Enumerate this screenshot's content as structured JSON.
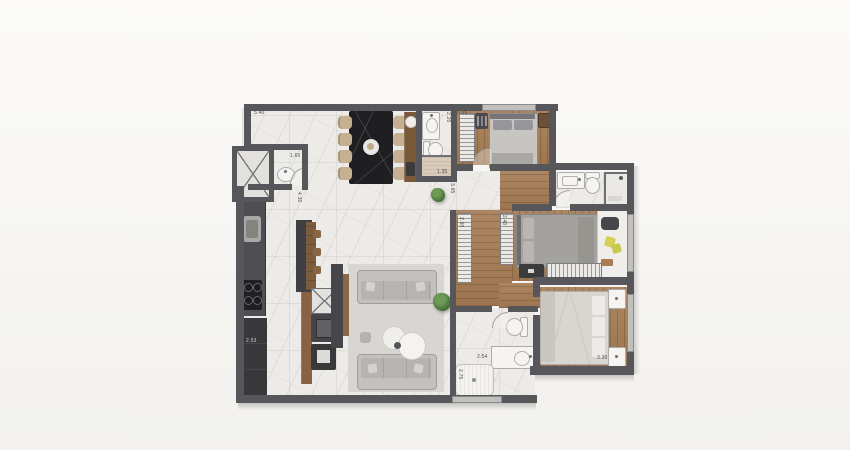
{
  "scene": {
    "type": "apartment-floor-plan-render",
    "style": "top-down 3D architectural render on white background"
  },
  "palette": {
    "wall": "#57565a",
    "marble_floor": "#edebe7",
    "wood_floor": "#a57c55",
    "kitchen_counter": "#4e4f53",
    "dining_table": "#1f1f22",
    "dining_chair": "#c6b092",
    "sofa": "#c3c1bd",
    "bed_gray": "#a3a29f",
    "bed_white": "#d9d6d1",
    "plant_green": "#4d7a3e",
    "pillow_yellow": "#d3d055",
    "label_text": "#4e4d49"
  },
  "dimensions": [
    {
      "text": "5.40",
      "x": 254,
      "y": 110,
      "v": false,
      "light": false
    },
    {
      "text": "1.65",
      "x": 290,
      "y": 153,
      "v": false,
      "light": false
    },
    {
      "text": "4.30",
      "x": 296,
      "y": 192,
      "v": true,
      "light": false
    },
    {
      "text": "2.20",
      "x": 445,
      "y": 112,
      "v": true,
      "light": false
    },
    {
      "text": "3.15",
      "x": 457,
      "y": 110,
      "v": false,
      "light": false
    },
    {
      "text": "1.35",
      "x": 437,
      "y": 169,
      "v": false,
      "light": false
    },
    {
      "text": "3.65",
      "x": 449,
      "y": 183,
      "v": true,
      "light": false
    },
    {
      "text": "2.90",
      "x": 458,
      "y": 217,
      "v": true,
      "light": false
    },
    {
      "text": "2.40",
      "x": 501,
      "y": 215,
      "v": true,
      "light": false
    },
    {
      "text": "2.53",
      "x": 246,
      "y": 338,
      "v": false,
      "light": true
    },
    {
      "text": "2.54",
      "x": 477,
      "y": 354,
      "v": false,
      "light": false
    },
    {
      "text": "2.75",
      "x": 457,
      "y": 369,
      "v": true,
      "light": false
    },
    {
      "text": "3.30",
      "x": 597,
      "y": 355,
      "v": false,
      "light": false
    }
  ]
}
